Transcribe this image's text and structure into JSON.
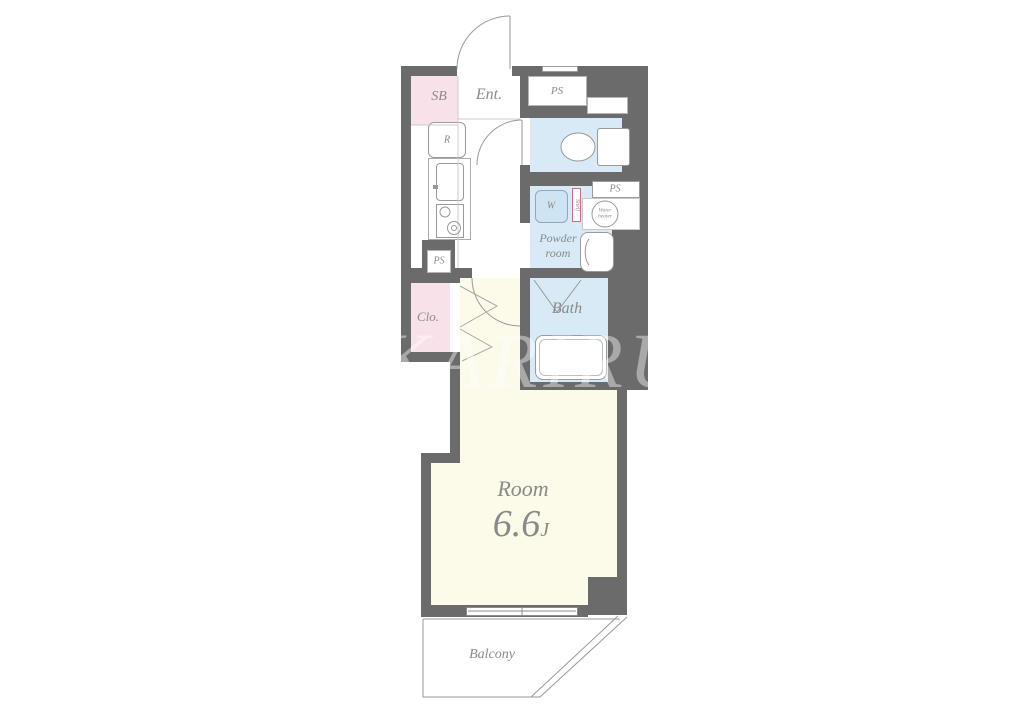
{
  "labels": {
    "sb": "SB",
    "entrance": "Ent.",
    "ps_top": "PS",
    "refrigerator": "R",
    "ps_kitchen": "PS",
    "washer": "W",
    "shelf": "Shelf",
    "ps_side": "PS",
    "water_heater_line1": "Water",
    "water_heater_line2": "heater",
    "powder_line1": "Powder",
    "powder_line2": "room",
    "closet": "Clo.",
    "bath": "Bath",
    "room": "Room",
    "room_size": "6.6",
    "room_size_unit": "J",
    "balcony": "Balcony",
    "watermark": "KARIRU"
  },
  "colors": {
    "wall": "#6b6b6b",
    "closet_pink": "#f9e1e9",
    "wet_area_blue": "#d7eaf6",
    "room_cream": "#fcfae8",
    "outline_gray": "#999999",
    "text_gray": "#8a8a8a",
    "shelf_accent": "#c2718c"
  }
}
